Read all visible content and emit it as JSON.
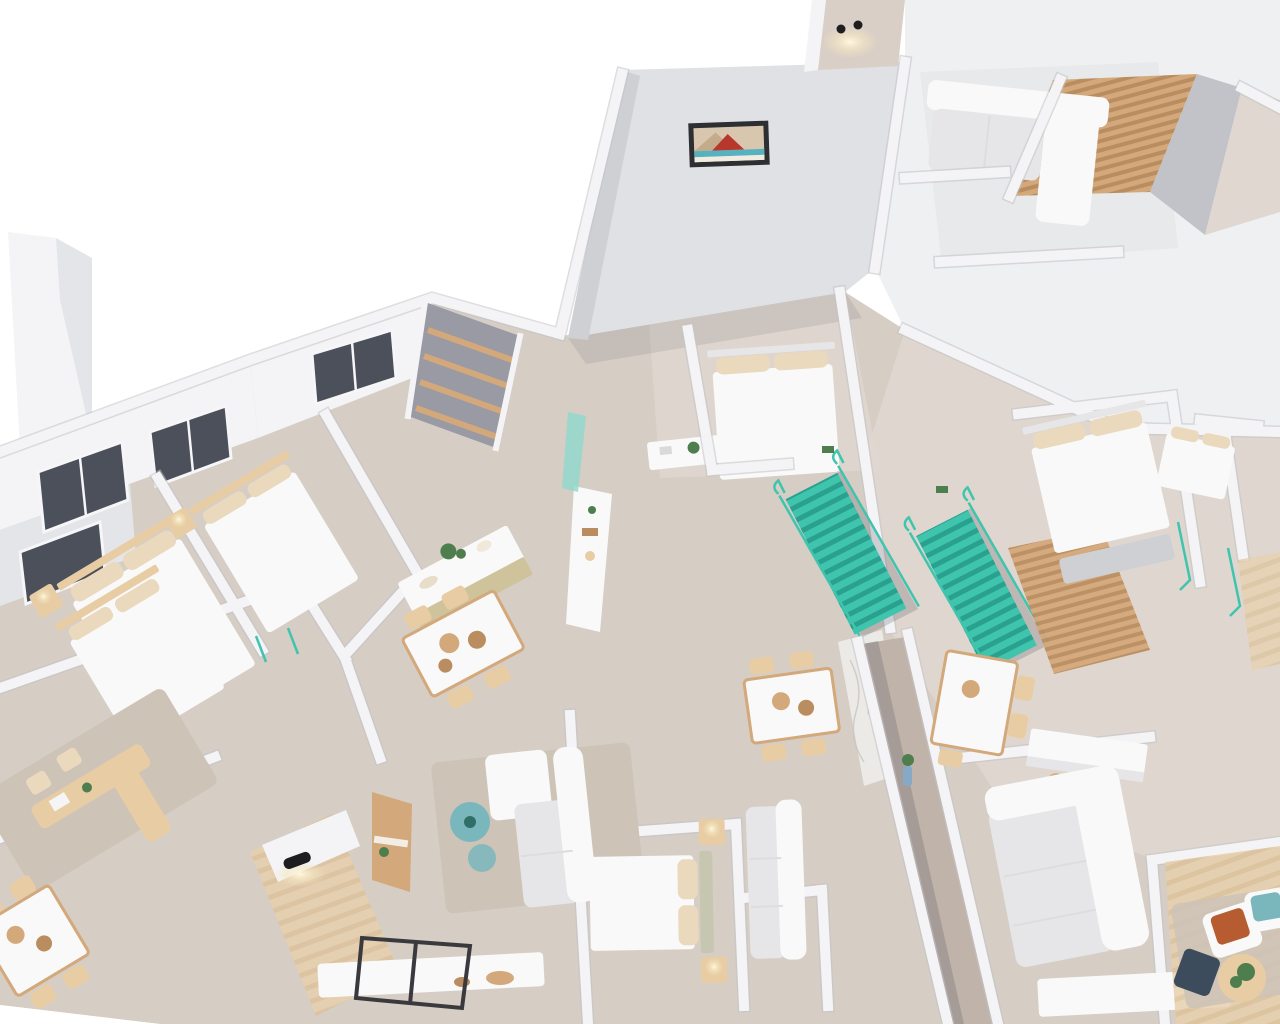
{
  "meta": {
    "type": "architectural-3d-floorplan-render",
    "description": "Axonometric 3D cutaway rendering of a furnished apartment floor, rotated diagonally on a white background, with white walls, beige floors, teal staircases and wood accents",
    "visible_text": []
  },
  "palette": {
    "background": "#ffffff",
    "roofTop": "#e0e1e4",
    "roofShade": "#cfd0d4",
    "wallBlock": "#eef0f2",
    "wall": "#f4f4f6",
    "wallShade": "#e4e5e8",
    "wallDark": "#c2c3c8",
    "floor": "#d6cdc5",
    "floorLight": "#e0d8d0",
    "corridorFloor": "#c0b4aa",
    "rug": "#cdc3b7",
    "furnitureWhite": "#f9f9f9",
    "furnitureShadow": "#e6e6e8",
    "pillow": "#ead9bc",
    "headboard": "#c6c6b1",
    "wood": "#d3a87a",
    "woodLight": "#e8cda4",
    "woodDark": "#b98d5f",
    "teal": "#3fc4ae",
    "tealDark": "#2aa18f",
    "tealGlass": "#8fd8cc",
    "accentRust": "#b65c30",
    "accentTeal": "#7ab7bd",
    "navy": "#3c4c5c",
    "glassDark": "#4b505a",
    "frameDark": "#3a3a3e",
    "lampBlack": "#1e1e20",
    "lampGlow": "#f6ecd0",
    "marble": "#eceae7",
    "plantGreen": "#4e7d4e",
    "vaseBlue": "#86a9c6"
  },
  "scene": {
    "view": "top-down axonometric, building mass runs diagonally from lower-left to upper-right; empty white canvas at top-left and bottom-left corners",
    "objects": {
      "teal_staircases": 2,
      "beds": 7,
      "sofas": 5,
      "dining_tables": 4,
      "kitchen_counters": 3,
      "desks": 1,
      "wardrobe_with_wood_shelves": 1,
      "wood_slat_pergolas": 2,
      "ceiling_lamps": 2,
      "wall_sconces": 2,
      "dark_framed_windows": 4,
      "wall_art_pictures": 1,
      "marble_feature_walls": 1,
      "terrace_lounges": 1,
      "plants": 6,
      "armchair_cushions": [
        "rust-orange",
        "teal"
      ]
    }
  }
}
